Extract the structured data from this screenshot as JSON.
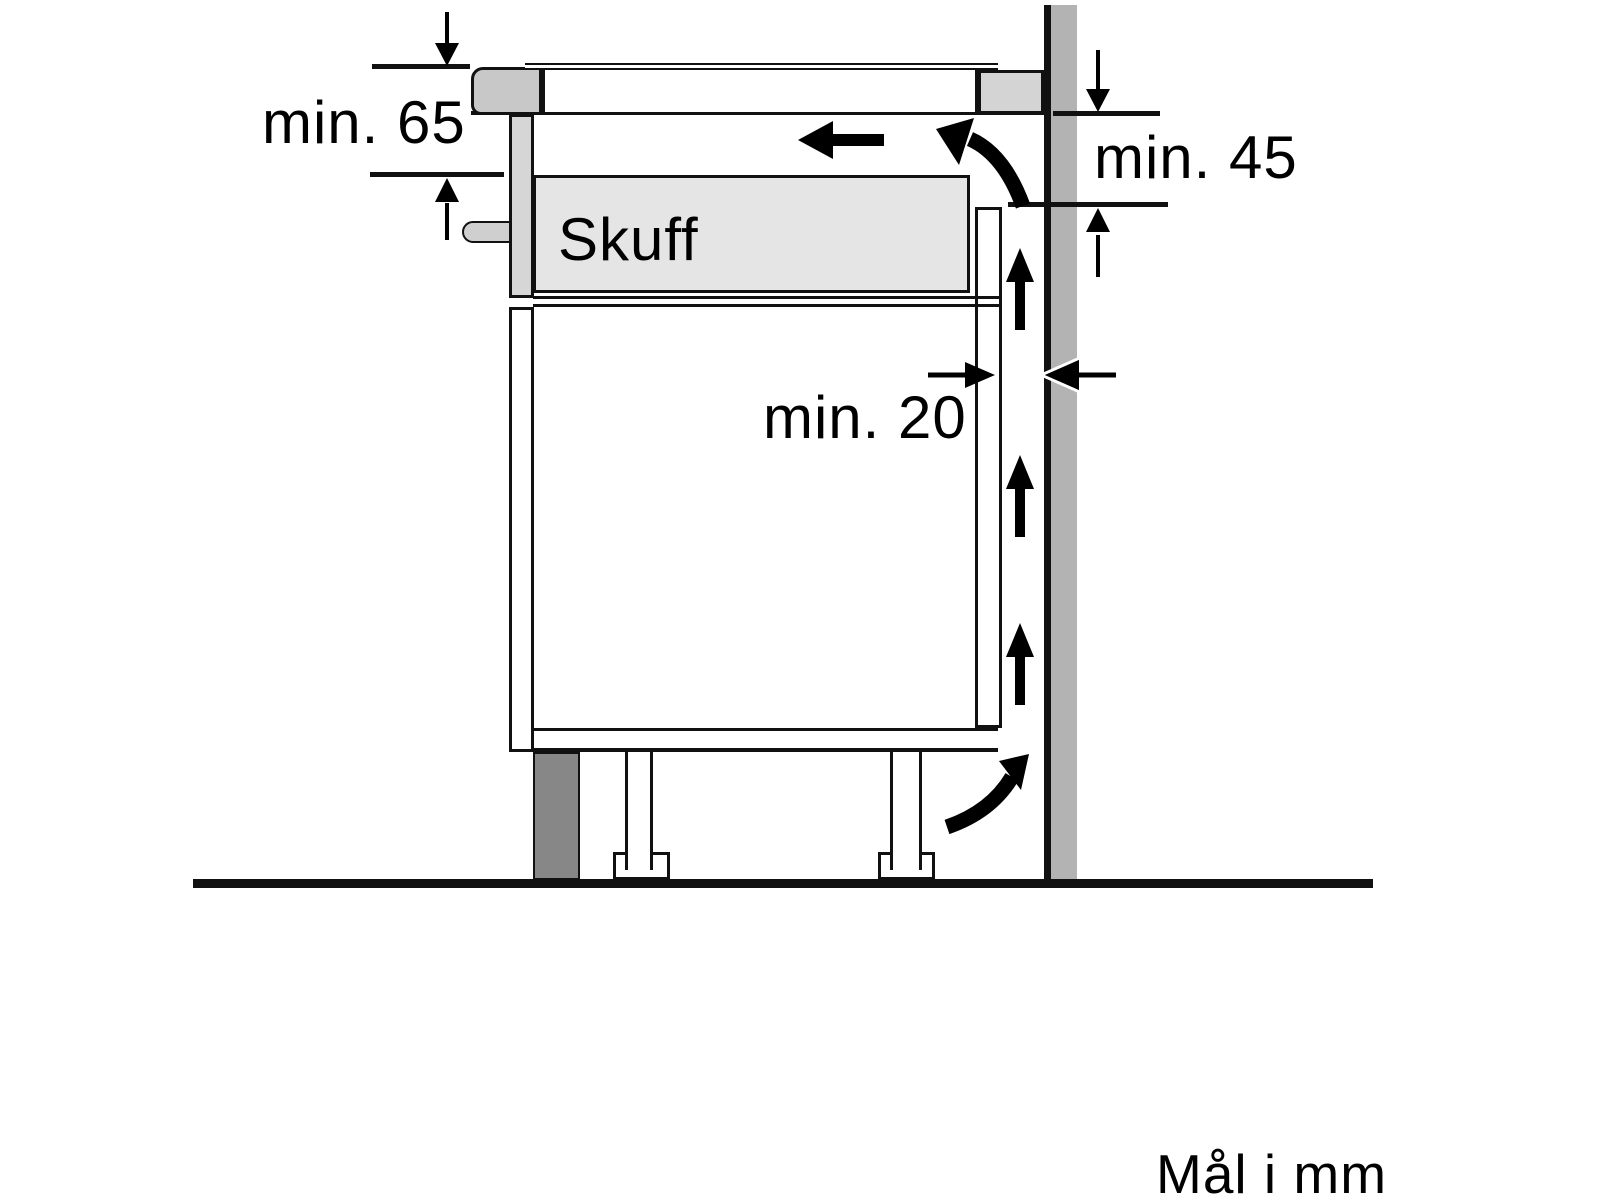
{
  "diagram": {
    "title_note": "Mål i mm",
    "labels": {
      "min65": "min. 65",
      "min45": "min. 45",
      "min20": "min. 20",
      "drawer": "Skuff"
    },
    "colors": {
      "outline": "#111111",
      "wall_fill": "#b3b3b3",
      "plinth_fill": "#878787",
      "worktop_front_fill": "#c8c8c8",
      "worktop_rear_fill": "#d4d4d4",
      "drawer_box_fill": "#e5e5e5",
      "drawer_front_fill": "#d6d6d6",
      "bracket_fill": "#cfcfcf",
      "arrow_color": "#000000"
    },
    "icons": [
      "down-dimension-arrow",
      "up-dimension-arrow",
      "right-dimension-arrow",
      "left-dimension-arrow",
      "airflow-left-arrow",
      "airflow-up-arrow",
      "airflow-curved-arrow"
    ]
  }
}
